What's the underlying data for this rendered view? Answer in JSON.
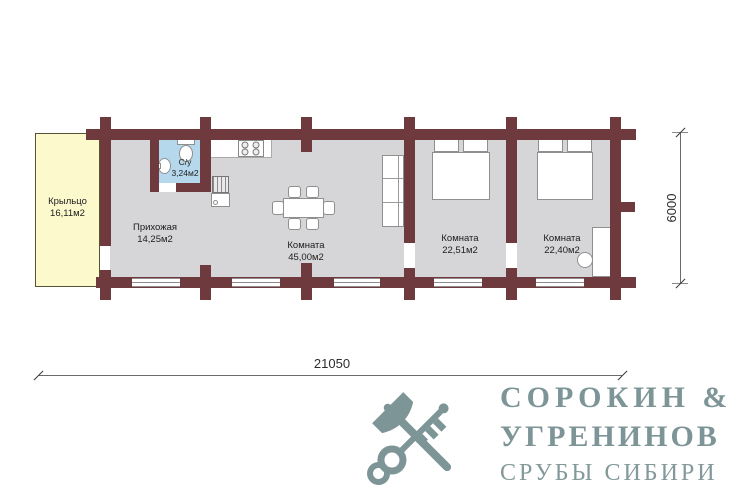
{
  "plan": {
    "rooms": [
      {
        "name": "Крыльцо",
        "area": "16,11м2"
      },
      {
        "name": "Прихожая",
        "area": "14,25м2"
      },
      {
        "name": "С/у",
        "area": "3,24м2"
      },
      {
        "name": "Комната",
        "area": "45,00м2"
      },
      {
        "name": "Комната",
        "area": "22,51м2"
      },
      {
        "name": "Комната",
        "area": "22,40м2"
      }
    ],
    "dimensions": {
      "total_width_mm": "21050",
      "total_depth_mm": "6000"
    },
    "colors": {
      "wall": "#6f3a3e",
      "floor": "#d6d5d7",
      "porch": "#fcf9cd",
      "bathroom": "#b5d8ec"
    }
  },
  "logo": {
    "line1": "СОРОКИН &",
    "line2": "УГРЕНИНОВ",
    "line3": "СРУБЫ СИБИРИ",
    "color": "#7d9596"
  }
}
